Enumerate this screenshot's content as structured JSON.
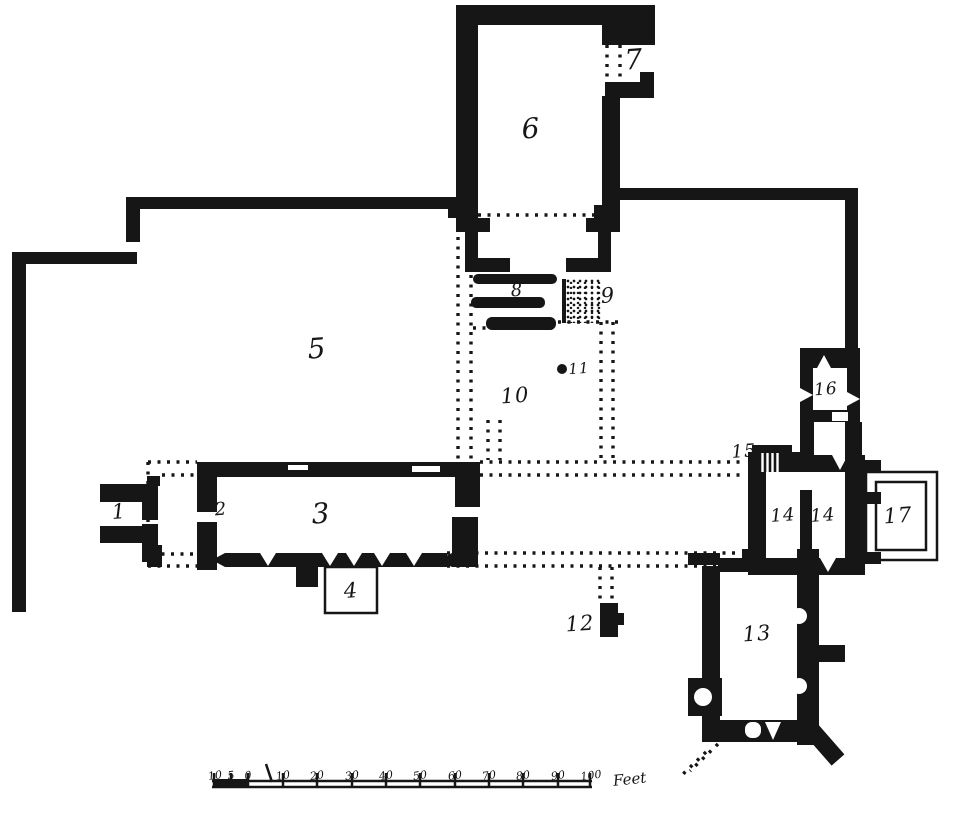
{
  "rooms": [
    "1",
    "2",
    "3",
    "4",
    "5",
    "6",
    "7",
    "8",
    "9",
    "10",
    "11",
    "12",
    "13",
    "14",
    "14",
    "15",
    "16",
    "17"
  ],
  "scale": {
    "ticks": [
      "10",
      "5",
      "0",
      "10",
      "20",
      "30",
      "40",
      "50",
      "60",
      "70",
      "80",
      "90",
      "100"
    ],
    "unit": "Feet"
  }
}
